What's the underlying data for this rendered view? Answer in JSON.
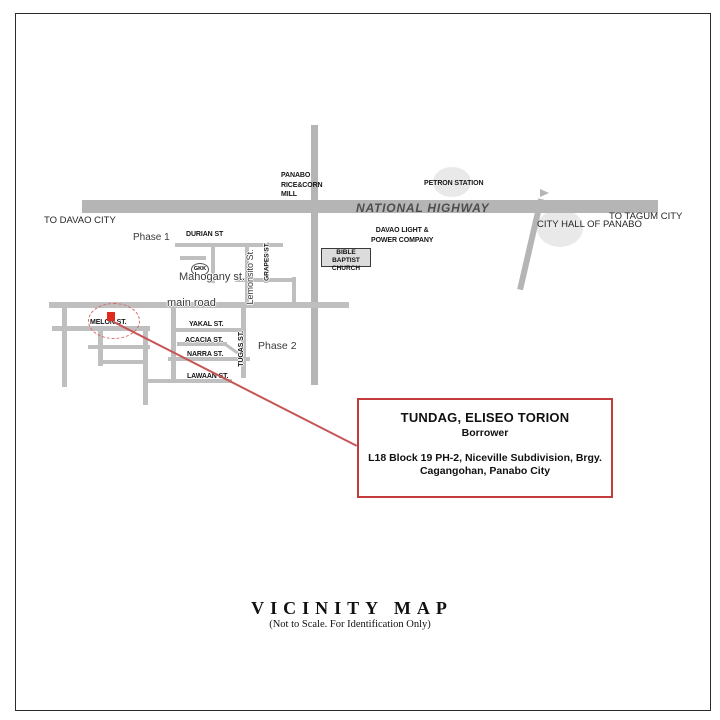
{
  "map": {
    "highway": "NATIONAL HIGHWAY",
    "to_west": "TO DAVAO CITY",
    "to_east": "TO TAGUM CITY",
    "phase1": "Phase 1",
    "phase2": "Phase 2",
    "streets": {
      "durian": "DURIAN ST",
      "mahogany": "Mahogany st.",
      "lemonsito": "Lemonsito St.",
      "grapes": "GRAPES ST.",
      "main_road": "main road",
      "melon": "MELON ST.",
      "yakal": "YAKAL ST.",
      "acacia": "ACACIA ST.",
      "narra": "NARRA ST.",
      "lawaan": "LAWAAN ST.",
      "tugas": "TUGAS ST."
    },
    "pois": {
      "rice_mill_l1": "PANABO",
      "rice_mill_l2": "RICE&CORN",
      "rice_mill_l3": "MILL",
      "petron": "PETRON STATION",
      "city_hall": "CITY HALL OF PANABO",
      "power_l1": "DAVAO LIGHT &",
      "power_l2": "POWER COMPANY",
      "church_l1": "BIBLE BAPTIST",
      "church_l2": "CHURCH",
      "gkk": "GKK"
    },
    "colors": {
      "road": "#bfbfbf",
      "highway": "#b5b5b5",
      "poi_circle": "#e9e9e9",
      "red_accent": "#c43b3b",
      "marker": "#e02a1e"
    }
  },
  "info_box": {
    "owner": "TUNDAG, ELISEO TORION",
    "role": "Borrower",
    "address1": "L18 Block 19 PH-2, Niceville Subdivision, Brgy.",
    "address2": "Cagangohan, Panabo City"
  },
  "footer": {
    "title": "VICINITY MAP",
    "subtitle": "(Not to Scale. For Identification Only)"
  }
}
